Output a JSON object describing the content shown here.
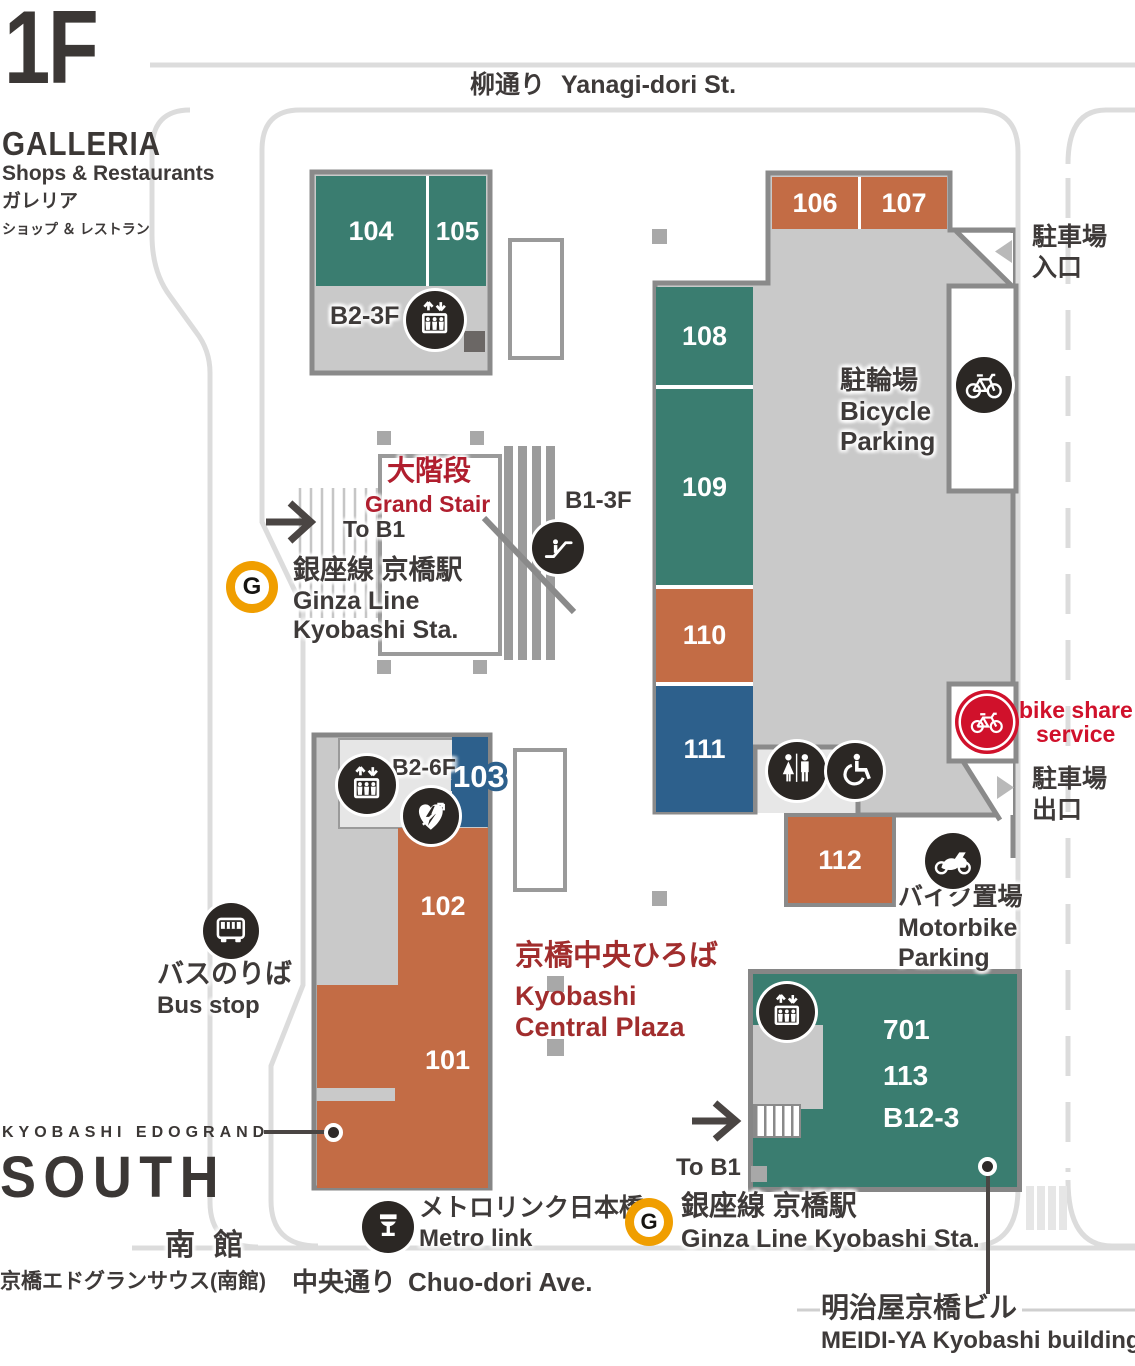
{
  "colors": {
    "teal": "#3a7d70",
    "orange": "#c36c45",
    "blue": "#2d608c",
    "stair_red": "#b01e2e",
    "plaza_red": "#a12d2d",
    "bikeshare_red": "#d0112b",
    "ginza_yellow": "#f09e00",
    "building_gray": "#c9c9c9",
    "road_gray": "#dcdcdc",
    "dark_text": "#3e3a39"
  },
  "header": {
    "floor": "1F",
    "name": "GALLERIA",
    "tagline_en": "Shops & Restaurants",
    "tagline_ja": "ガレリア",
    "tagline_ja_sub": "ショップ ＆ レストラン"
  },
  "streets": {
    "yanagi_ja": "柳通り",
    "yanagi_en": "Yanagi-dori St.",
    "chuo_ja": "中央通り",
    "chuo_en": "Chuo-dori Ave."
  },
  "rooms": {
    "r101": "101",
    "r102": "102",
    "r103": "103",
    "r104": "104",
    "r105": "105",
    "r106": "106",
    "r107": "107",
    "r108": "108",
    "r109": "109",
    "r110": "110",
    "r111": "111",
    "r112": "112",
    "r701": "701",
    "r113": "113",
    "rb123": "B12-3"
  },
  "levels": {
    "north_block": "B2-3F",
    "grand_stair": "B1-3F",
    "south_block": "B2-6F"
  },
  "grand_stair": {
    "ja": "大階段",
    "en": "Grand Stair",
    "to_b1": "To B1"
  },
  "ginza": {
    "g": "G",
    "sta_ja": "銀座線 京橋駅",
    "line_en": "Ginza Line",
    "sta_en": "Kyobashi Sta.",
    "sta_en_full": "Ginza Line Kyobashi Sta."
  },
  "facilities": {
    "bicycle_ja": "駐輪場",
    "bicycle_en_1": "Bicycle",
    "bicycle_en_2": "Parking",
    "motorbike_ja": "バイク置場",
    "motorbike_en_1": "Motorbike",
    "motorbike_en_2": "Parking",
    "bikeshare_1": "bike share",
    "bikeshare_2": "service",
    "parking_entrance_ja_1": "駐車場",
    "parking_entrance_ja_2": "入口",
    "parking_exit_ja_1": "駐車場",
    "parking_exit_ja_2": "出口",
    "bus_ja": "バスのりば",
    "bus_en": "Bus stop",
    "metrolink_ja": "メトロリンク日本橋",
    "metrolink_en": "Metro link"
  },
  "plaza": {
    "ja": "京橋中央ひろば",
    "en_1": "Kyobashi",
    "en_2": "Central Plaza"
  },
  "south_wing": {
    "brand": "KYOBASHI EDOGRAND",
    "name": "SOUTH",
    "ja": "南 館",
    "full_ja": "京橋エドグランサウス(南館)"
  },
  "meidiya": {
    "ja": "明治屋京橋ビル",
    "en": "MEIDI-YA Kyobashi building"
  }
}
